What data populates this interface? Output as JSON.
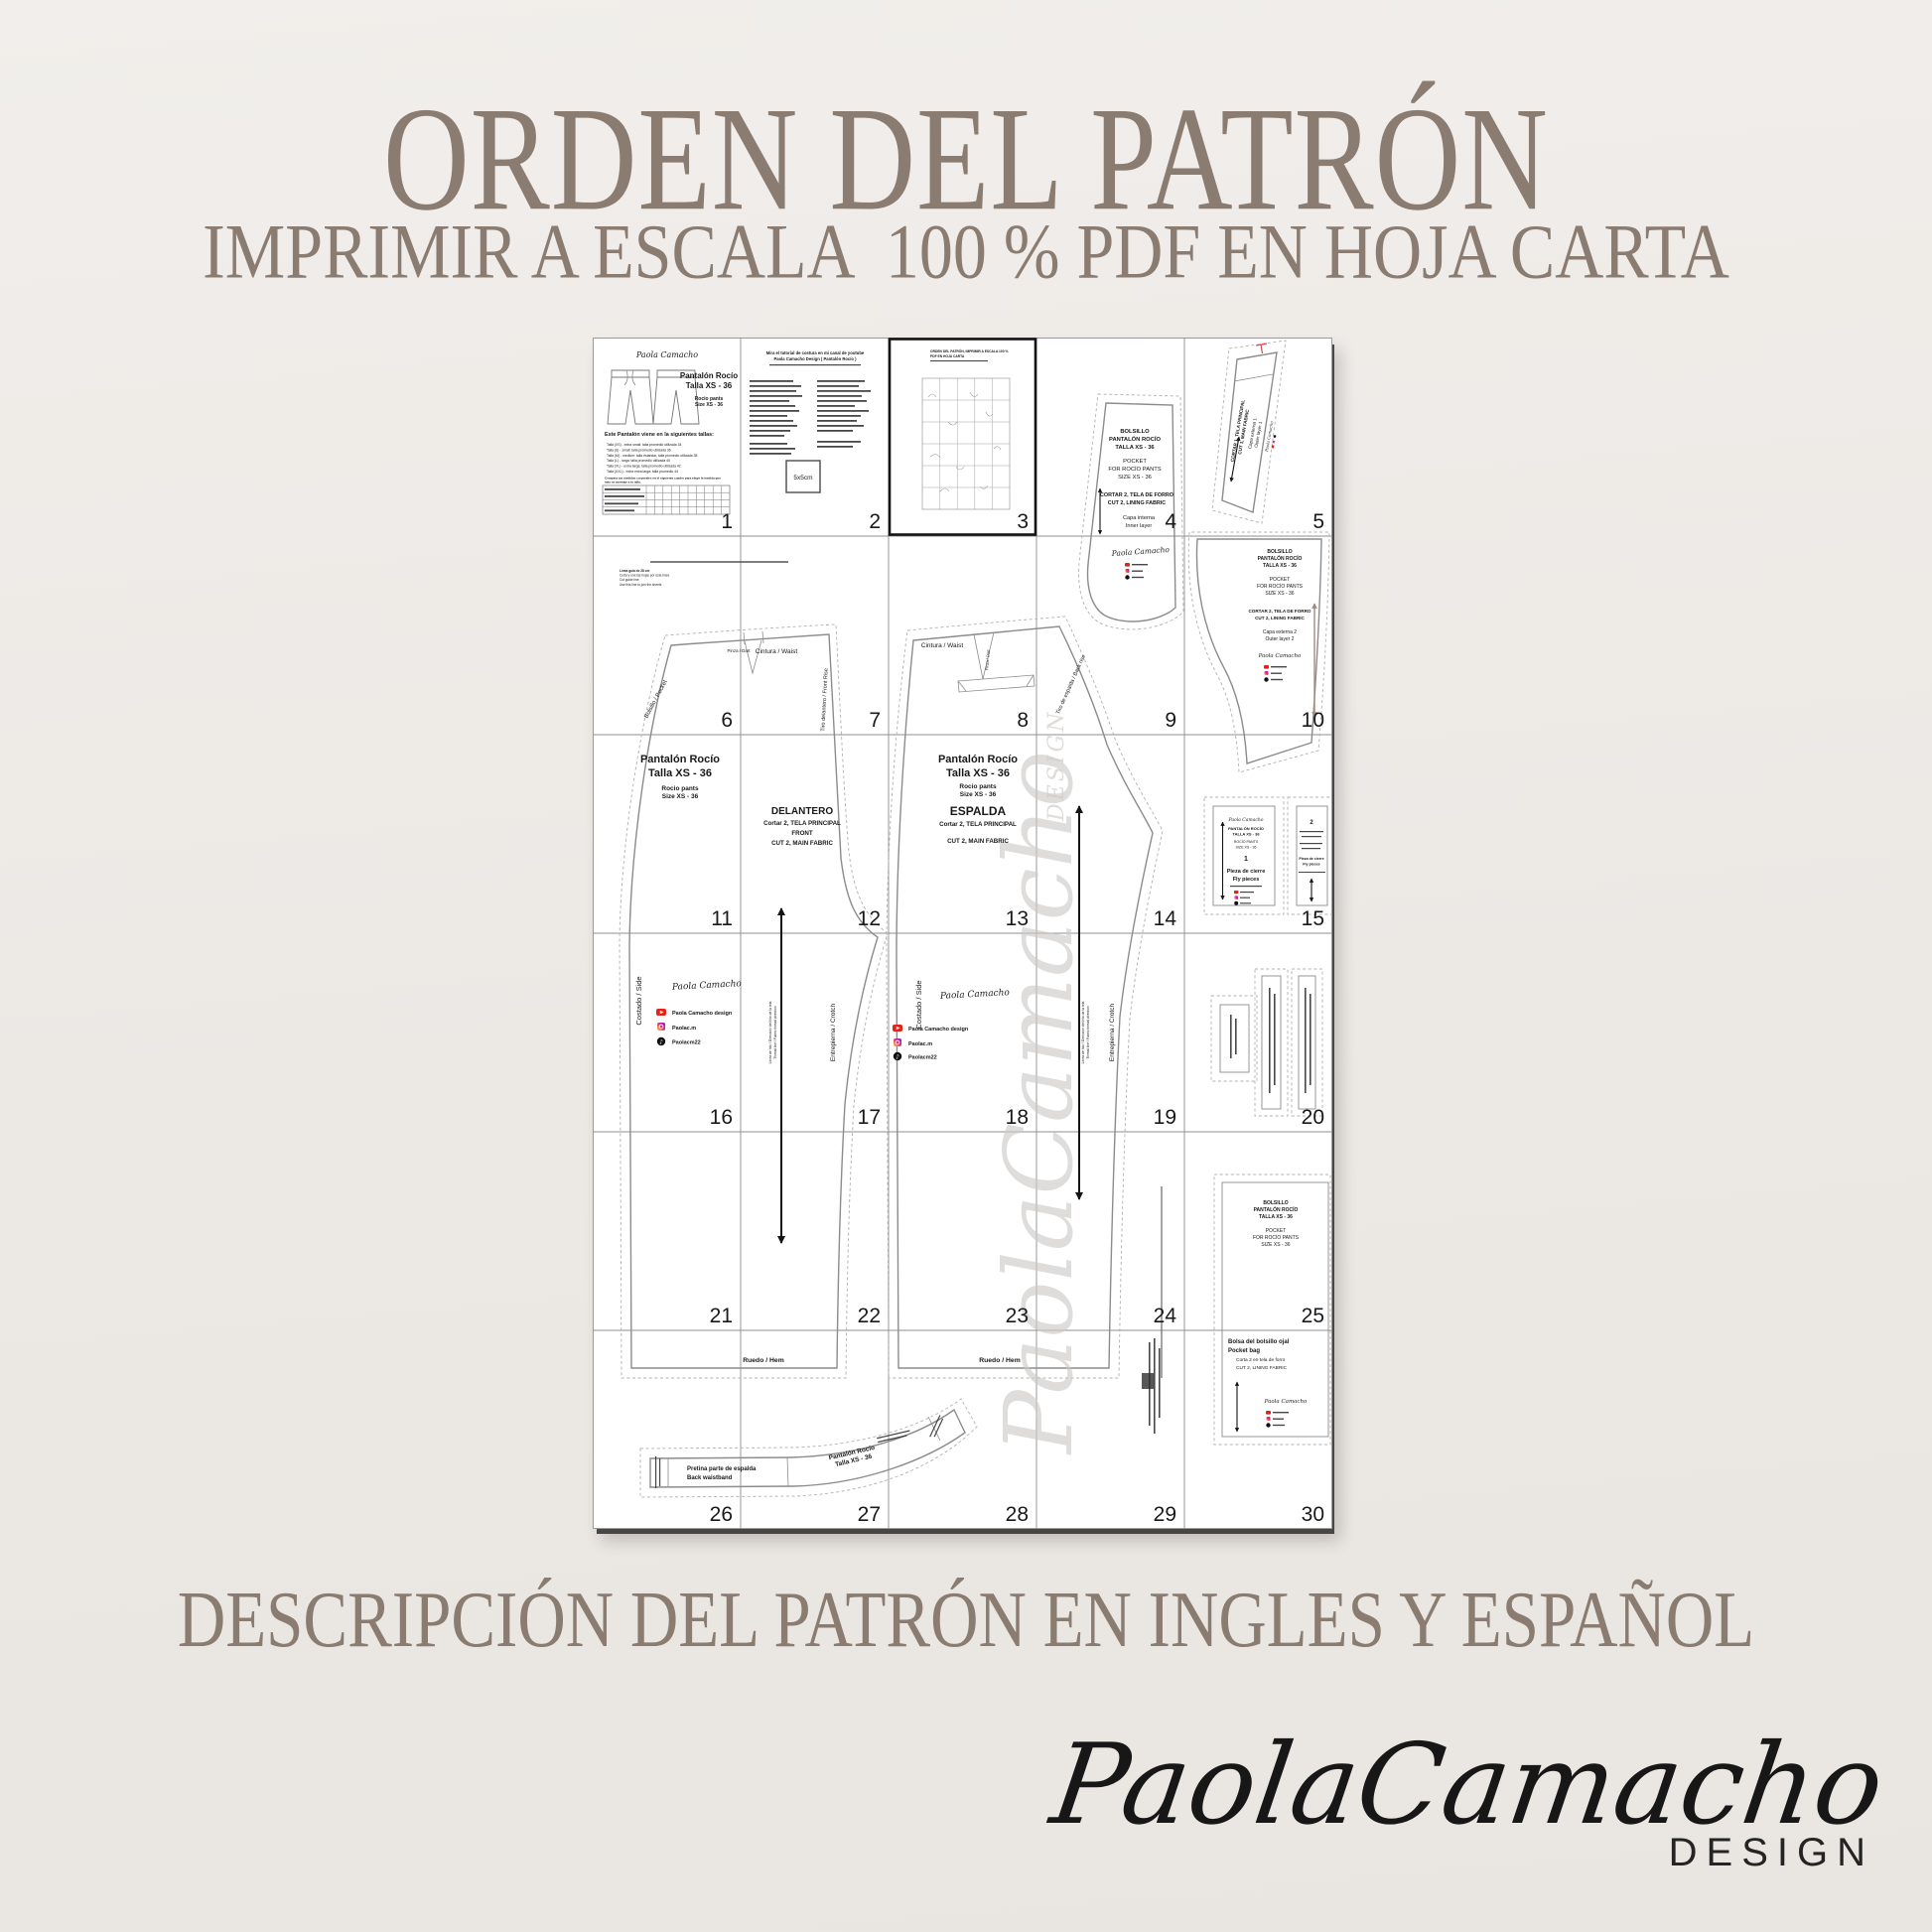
{
  "colors": {
    "background": "#edeae6",
    "heading": "#8a7c71",
    "sheet": "#ffffff",
    "outline_gray": "#8c8c8c",
    "accent_red": "#e0474c",
    "youtube_red": "#e62117",
    "watermark_gray": "#ccc9c6"
  },
  "header": {
    "title": "ORDEN DEL PATRÓN",
    "subtitle": "IMPRIMIR A ESCALA  100 % PDF EN HOJA CARTA"
  },
  "footer": {
    "description": "DESCRIPCIÓN DEL PATRÓN EN INGLES Y ESPAÑOL",
    "brand_script": "PaolaCamacho",
    "brand_sub": "DESIGN"
  },
  "sheet": {
    "pages": [
      "1",
      "2",
      "3",
      "4",
      "5",
      "6",
      "7",
      "8",
      "9",
      "10",
      "11",
      "12",
      "13",
      "14",
      "15",
      "16",
      "17",
      "18",
      "19",
      "20",
      "21",
      "22",
      "23",
      "24",
      "25",
      "26",
      "27",
      "28",
      "29",
      "30"
    ],
    "signature": "Paola Camacho",
    "watermark": {
      "script": "PaolaCamacho",
      "sub": "DESIGN"
    },
    "social": {
      "youtube": "Paola Camacho design",
      "instagram": "Paolac.m",
      "tiktok": "Paolacm22"
    },
    "piece_name": [
      "Pantalón Rocío",
      "Talla XS - 36",
      "Rocio pants",
      "Size XS - 36"
    ],
    "page1": {
      "sizes_heading": "Este Pantalón viene en la siguientes tallas:",
      "size_lines": [
        "Talla (XS) - extra small: talla promedio utilizada 34",
        "Talla (S) - small: talla promedio utilizada 36",
        "Talla (M) - medium: talla estandar, talla promedio utilizada 38",
        "Talla (L) - larga: talla promedio utilizada 40",
        "Talla (XL) - extra larga: talla promedio utilizada 42",
        "Talla (XXL) - extra extra larga: talla promedio 44"
      ],
      "note_line1": "Compara tus medidas corporales en el siguiente cuadro para elegir la medida que",
      "note_line2": "más se asemeje a tu talla."
    },
    "page2": {
      "heading_line1": "Mira el tutorial de costura en mi canal de youtube",
      "heading_line2": "Paola Camacho Design ( Pantalón Rocío )",
      "test_square": "5x5cm"
    },
    "page3": {
      "heading_line1": "ORDEN DEL PATRÓN, IMPRIMIR A ESCALA 100 %",
      "heading_line2": "PDF EN HOJA CARTA"
    },
    "labels": {
      "waist": "Cintura / Waist",
      "dart": "Pinza / Dart",
      "pocket": "Bolsillo / Pocket",
      "front_rise": "Tiro delantero / Front Rise",
      "back_rise": "Tiro de espalda / Back rise",
      "side": "Costado / Side",
      "crotch": "Entrepierna / Crotch",
      "hem": "Ruedo / Hem",
      "grain_es": "Línea de hilo / Dirección del hilo de la tela",
      "grain_en": "Thread line / Fabric thread direction",
      "guide1": "Línea guía de 28 cm",
      "guide2": "Corta y une las hojas por esta línea",
      "guide3": "Cut guide line",
      "guide4": "Use this line to join the sheets"
    },
    "front_piece": [
      "DELANTERO",
      "Cortar 2, TELA PRINCIPAL",
      "FRONT",
      "CUT 2, MAIN FABRIC"
    ],
    "back_piece": [
      "ESPALDA",
      "Cortar 2, TELA PRINCIPAL",
      "CUT 2, MAIN FABRIC"
    ],
    "pocket_inner": {
      "lines": [
        "BOLSILLO",
        "PANTALÓN ROCÍO",
        "TALLA XS - 36",
        "POCKET",
        "FOR ROCÍO PANTS",
        "SIZE XS - 36",
        "CORTAR 2, TELA DE FORRO",
        "CUT 2, LINING FABRIC",
        "Capa interna",
        "Inner layer"
      ]
    },
    "pocket_outer": {
      "lines": [
        "BOLSILLO",
        "PANTALÓN ROCÍO",
        "TALLA XS - 36",
        "POCKET",
        "FOR ROCÍO PANTS",
        "SIZE XS - 36",
        "CORTAR 2, TELA DE FORRO",
        "CUT 2, LINING FABRIC",
        "Capa externa 2",
        "Outer layer 2"
      ]
    },
    "waistband_front": {
      "lines": [
        "CORTAR 1, TELA PRINCIPAL",
        "CUT 1, MAIN FABRIC",
        "Capa externa 1",
        "Outer layer 1"
      ]
    },
    "fly": {
      "num1": "1",
      "num2": "2",
      "name": [
        "PANTALÓN ROCÍO",
        "TALLA XS - 36",
        "ROCÍO PANTS",
        "SIZE XS - 36"
      ],
      "label1": "Pieza de cierre",
      "label2": "Fly pieces"
    },
    "pocket_bag": {
      "lines": [
        "BOLSILLO",
        "PANTALÓN ROCÍO",
        "TALLA XS - 36",
        "POCKET",
        "FOR ROCÍO PANTS",
        "SIZE XS - 36"
      ]
    },
    "pocket_bag_welt": {
      "lines": [
        "Bolsa del bolsillo ojal",
        "Pocket bag",
        "Corta 2 en tela de forro",
        "CUT 2, LINING FABRIC"
      ]
    },
    "waistband_back": {
      "l1": "Pretina parte de espalda",
      "l2": "Back waistband",
      "rot1": "Pantalón Rocío",
      "rot2": "Talla XS - 36"
    }
  }
}
